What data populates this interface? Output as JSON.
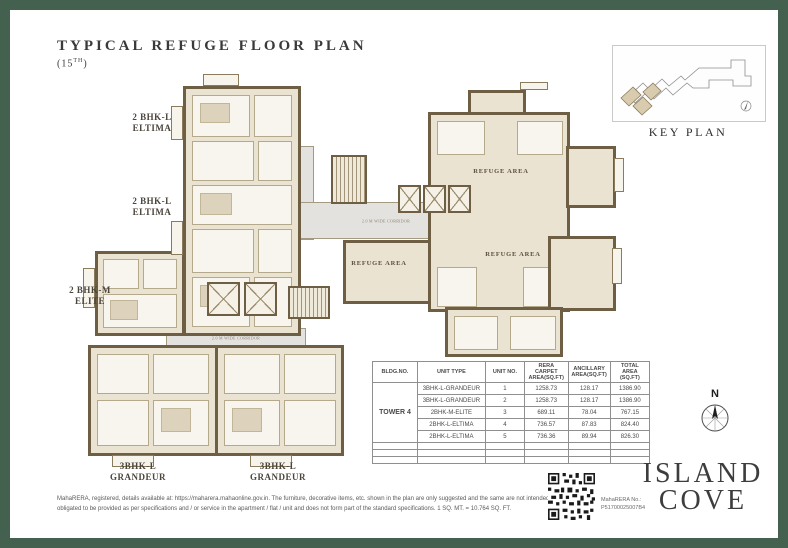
{
  "header": {
    "title": "TYPICAL REFUGE FLOOR PLAN",
    "floor_note_prefix": "(15",
    "floor_note_sup": "TH",
    "floor_note_suffix": ")"
  },
  "key_plan": {
    "label": "KEY PLAN"
  },
  "compass": {
    "north_label": "N"
  },
  "plan": {
    "unit_labels": [
      {
        "line1": "2 BHK-L",
        "line2": "ELTIMA"
      },
      {
        "line1": "2 BHK-L",
        "line2": "ELTIMA"
      },
      {
        "line1": "2 BHK-M",
        "line2": "ELITE"
      },
      {
        "line1": "3BHK-L",
        "line2": "GRANDEUR"
      },
      {
        "line1": "3BHK-L",
        "line2": "GRANDEUR"
      }
    ],
    "refuge_labels": [
      "REFUGE AREA",
      "REFUGE AREA",
      "REFUGE AREA"
    ],
    "corridor_label": "2.0 M WIDE CORRIDOR"
  },
  "table": {
    "headers": [
      "BLDG.NO.",
      "UNIT TYPE",
      "UNIT NO.",
      "RERA CARPET AREA(SQ.FT)",
      "ANCILLARY AREA(SQ.FT)",
      "TOTAL AREA (SQ.FT)"
    ],
    "bldg_no": "TOWER 4",
    "rows": [
      {
        "unit_type": "3BHK-L-GRANDEUR",
        "unit_no": "1",
        "rera": "1258.73",
        "ancillary": "128.17",
        "total": "1386.90"
      },
      {
        "unit_type": "3BHK-L-GRANDEUR",
        "unit_no": "2",
        "rera": "1258.73",
        "ancillary": "128.17",
        "total": "1386.90"
      },
      {
        "unit_type": "2BHK-M-ELITE",
        "unit_no": "3",
        "rera": "689.11",
        "ancillary": "78.04",
        "total": "767.15"
      },
      {
        "unit_type": "2BHK-L-ELTIMA",
        "unit_no": "4",
        "rera": "736.57",
        "ancillary": "87.83",
        "total": "824.40"
      },
      {
        "unit_type": "2BHK-L-ELTIMA",
        "unit_no": "5",
        "rera": "736.36",
        "ancillary": "89.94",
        "total": "826.30"
      }
    ]
  },
  "footer": {
    "disclaimer": "MahaRERA, registered, details available at: https://maharera.mahaonline.gov.in. The furniture, decorative items, etc. shown in the plan are only suggested and the same are not intended or obligated to be provided as per specifications and / or service in the apartment / flat / unit and does not form part of the standard specifications. 1 SQ. MT. = 10.764 SQ. FT.",
    "rera_no_label": "MahaRERA No.:",
    "rera_no": "P51700025007B4",
    "logo_line1": "ISLAND",
    "logo_line2": "COVE"
  },
  "colors": {
    "frame_green": "#44604e",
    "wall_brown": "#6e5e43",
    "floor_beige": "#ebe3d2",
    "corridor_gray": "#e3e2de",
    "text_dark": "#3a3a3a"
  }
}
